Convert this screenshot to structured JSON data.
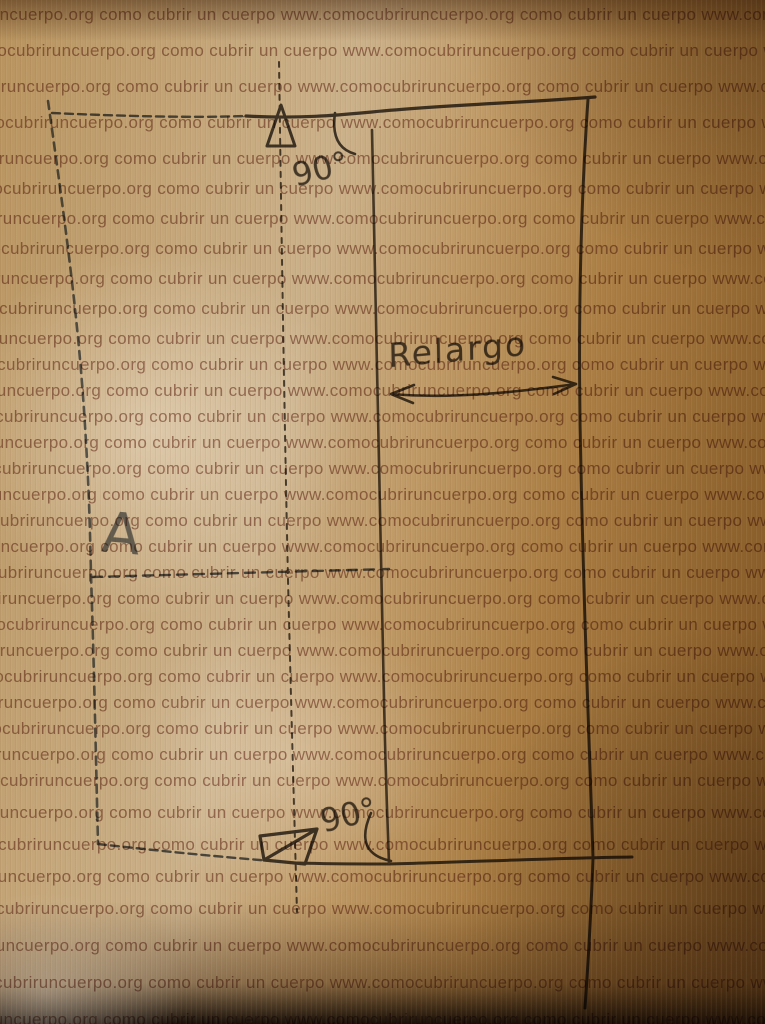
{
  "photo": {
    "watermark_text": "como cubrir un cuerpo www.comocubriruncuerpo.org",
    "labels": {
      "top_angle": "90°",
      "bottom_angle": "90°",
      "width_label": "Relargo",
      "point_label": "A"
    },
    "colors": {
      "paper_light": "#cbb18a",
      "paper_dark": "#7c5222",
      "watermark": "#7a3c2a",
      "pencil": "#3e3933",
      "pencil_mid": "#4a443c",
      "blue_pencil": "#59636f",
      "blue_pencil_dark": "#4d545e"
    }
  }
}
